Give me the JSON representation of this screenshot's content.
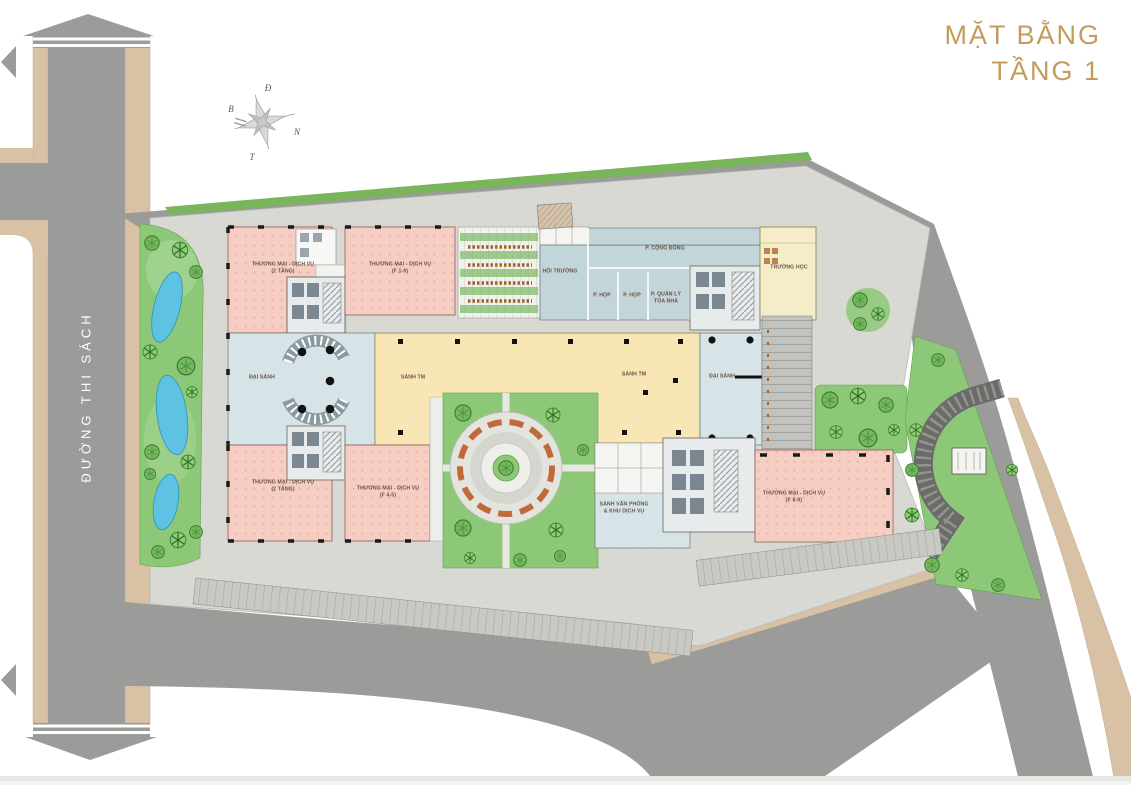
{
  "title": {
    "line1": "MẶT BẰNG",
    "line2": "TẦNG 1"
  },
  "street": {
    "name": "ĐƯỜNG THI SÁCH"
  },
  "compass": {
    "top": "Đ",
    "left": "B",
    "right": "N",
    "bottom": "T"
  },
  "colors": {
    "accent_gold": "#C49B5F",
    "road_gray": "#9B9B99",
    "sidewalk_tan": "#D8C1A4",
    "plaza_gray": "#D9D9D4",
    "retail_pink": "#F5CDC3",
    "lobby_blue": "#D6E4E8",
    "community_teal": "#C2D5D8",
    "hall_yellow": "#F8E7B4",
    "school_yellow": "#F5EDC9",
    "landscape_green": "#8CC878",
    "pool_blue": "#5EC2E2",
    "label_text": "#6B5147"
  },
  "rooms": [
    {
      "id": "retail-nw",
      "label": "THƯƠNG MẠI - DỊCH VỤ",
      "sub": "(2 TẦNG)"
    },
    {
      "id": "retail-n",
      "label": "THƯƠNG MẠI - DỊCH VỤ",
      "sub": "(F 1-9)"
    },
    {
      "id": "auditorium",
      "label": "HỘI TRƯỜNG",
      "sub": ""
    },
    {
      "id": "community",
      "label": "P. CỘNG ĐỒNG",
      "sub": ""
    },
    {
      "id": "meeting-1",
      "label": "P. HỌP",
      "sub": ""
    },
    {
      "id": "meeting-2",
      "label": "P. HỌP",
      "sub": ""
    },
    {
      "id": "management",
      "label": "P. QUẢN LÝ",
      "sub": "TÒA NHÀ"
    },
    {
      "id": "school",
      "label": "TRƯỜNG HỌC",
      "sub": ""
    },
    {
      "id": "lobby-west",
      "label": "ĐẠI SẢNH",
      "sub": ""
    },
    {
      "id": "retail-hall-w",
      "label": "SẢNH TM",
      "sub": ""
    },
    {
      "id": "retail-hall-e",
      "label": "SẢNH TM",
      "sub": ""
    },
    {
      "id": "lobby-east",
      "label": "ĐẠI SẢNH",
      "sub": ""
    },
    {
      "id": "retail-sw",
      "label": "THƯƠNG MẠI - DỊCH VỤ",
      "sub": "(2 TẦNG)"
    },
    {
      "id": "retail-s",
      "label": "THƯƠNG MẠI - DỊCH VỤ",
      "sub": "(F 4-5)"
    },
    {
      "id": "office-lobby",
      "label": "SẢNH VĂN PHÒNG",
      "sub": "& KHU DỊCH VỤ"
    },
    {
      "id": "retail-se",
      "label": "THƯƠNG MẠI - DỊCH VỤ",
      "sub": "(F 8-9)"
    }
  ]
}
